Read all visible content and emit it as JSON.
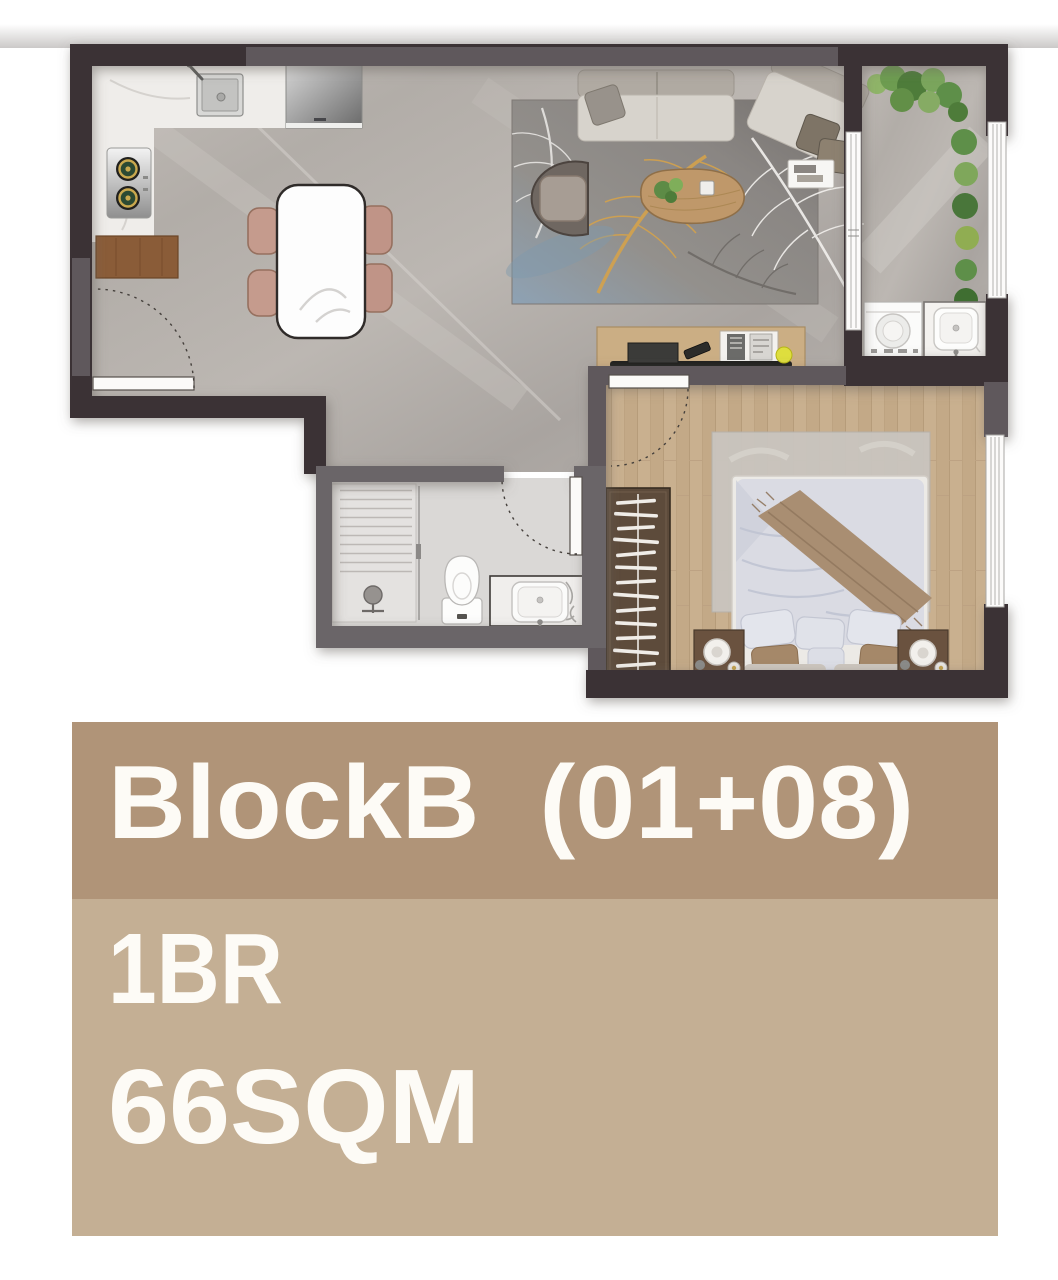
{
  "panel": {
    "title": "BlockB  (01+08)",
    "bedrooms": "1BR",
    "area": "66SQM",
    "colors": {
      "band_top": "#B09478",
      "band_bottom": "#C4AF94",
      "text": "#FDFBF6"
    }
  },
  "floor_plan": {
    "icons": [
      "kitchen-sink-icon",
      "gas-stove-icon",
      "refrigerator-icon",
      "kitchen-cabinet-icon",
      "dining-table-icon",
      "dining-chair-icon",
      "sofa-icon",
      "armchair-icon",
      "coffee-table-icon",
      "feather-rug-icon",
      "side-tray-icon",
      "tv-console-icon",
      "tv-icon",
      "remote-icon",
      "balcony-plants-icon",
      "washing-machine-icon",
      "laundry-sink-icon",
      "bed-icon",
      "pillow-icon",
      "throw-blanket-icon",
      "nightstand-icon",
      "table-lamp-icon",
      "wardrobe-hangers-icon",
      "bedroom-rug-icon",
      "shower-icon",
      "shower-head-icon",
      "toilet-icon",
      "vanity-basin-icon",
      "door-swing-icon",
      "window-icon",
      "sliding-door-icon",
      "entry-threshold-icon"
    ],
    "colors": {
      "wall_dark": "#3B3334",
      "wall_gray": "#5F595B",
      "wall_bath": "#6B6568",
      "floor_stone": "#B4AFAA",
      "floor_wood": "#C8AF8E",
      "floor_bath": "#DAD8D6",
      "counter_marble": "#EFEDEA",
      "rug_gold": "#D4A24C",
      "plant_green": "#5E8F49"
    }
  }
}
